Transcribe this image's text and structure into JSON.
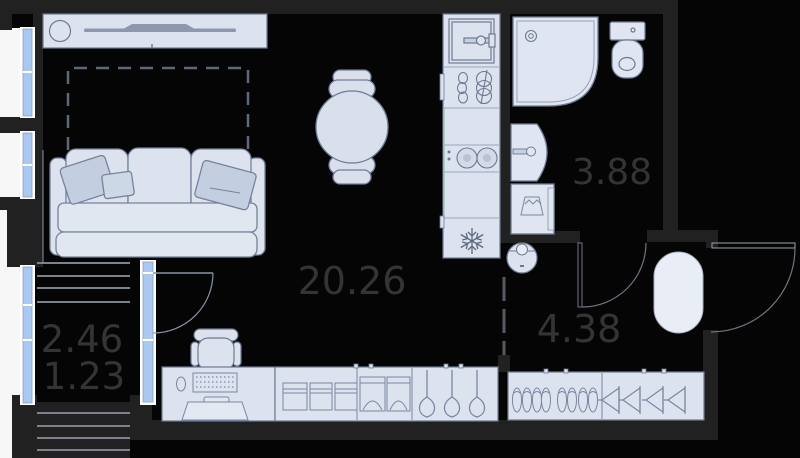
{
  "plan": {
    "title": "studio-apartment-floor-plan",
    "rooms": {
      "living": {
        "name": "living-room",
        "area": "20.26"
      },
      "bathroom": {
        "name": "bathroom",
        "area": "3.88"
      },
      "hallway": {
        "name": "hallway",
        "area": "4.38"
      },
      "balcony": {
        "name": "balcony",
        "area_total": "2.46",
        "area_reduced": "1.23"
      }
    },
    "colors": {
      "background": "#050505",
      "wall": "#212121",
      "exterior": "#ffffff",
      "furniture_fill": "#dce3ee",
      "furniture_stroke": "#6f7a92",
      "pillow_fill": "#c3cfe0",
      "window_glass": "#aac9f0",
      "rug_fill": "#e9edf5",
      "label_text": "#343434",
      "hatch_line": "#7d838c",
      "accent_teal": "#8fbfae"
    },
    "furniture_icons": [
      "tv-stand-icon",
      "bed-outline-icon",
      "sofa-icon",
      "dining-table-icon",
      "chair-icon",
      "kitchen-sink-icon",
      "dish-rack-icon",
      "cooktop-icon",
      "fridge-snowflake-icon",
      "shower-icon",
      "toilet-icon",
      "bathroom-sink-icon",
      "washing-machine-icon",
      "robot-vacuum-icon",
      "entry-rug-icon",
      "desk-icon",
      "desk-chair-icon",
      "monitor-icon",
      "keyboard-icon",
      "wardrobe-icon",
      "folded-clothes-icon",
      "hanger-icon",
      "shoe-icon",
      "balcony-door-icon",
      "entrance-door-icon",
      "window-icon"
    ]
  }
}
